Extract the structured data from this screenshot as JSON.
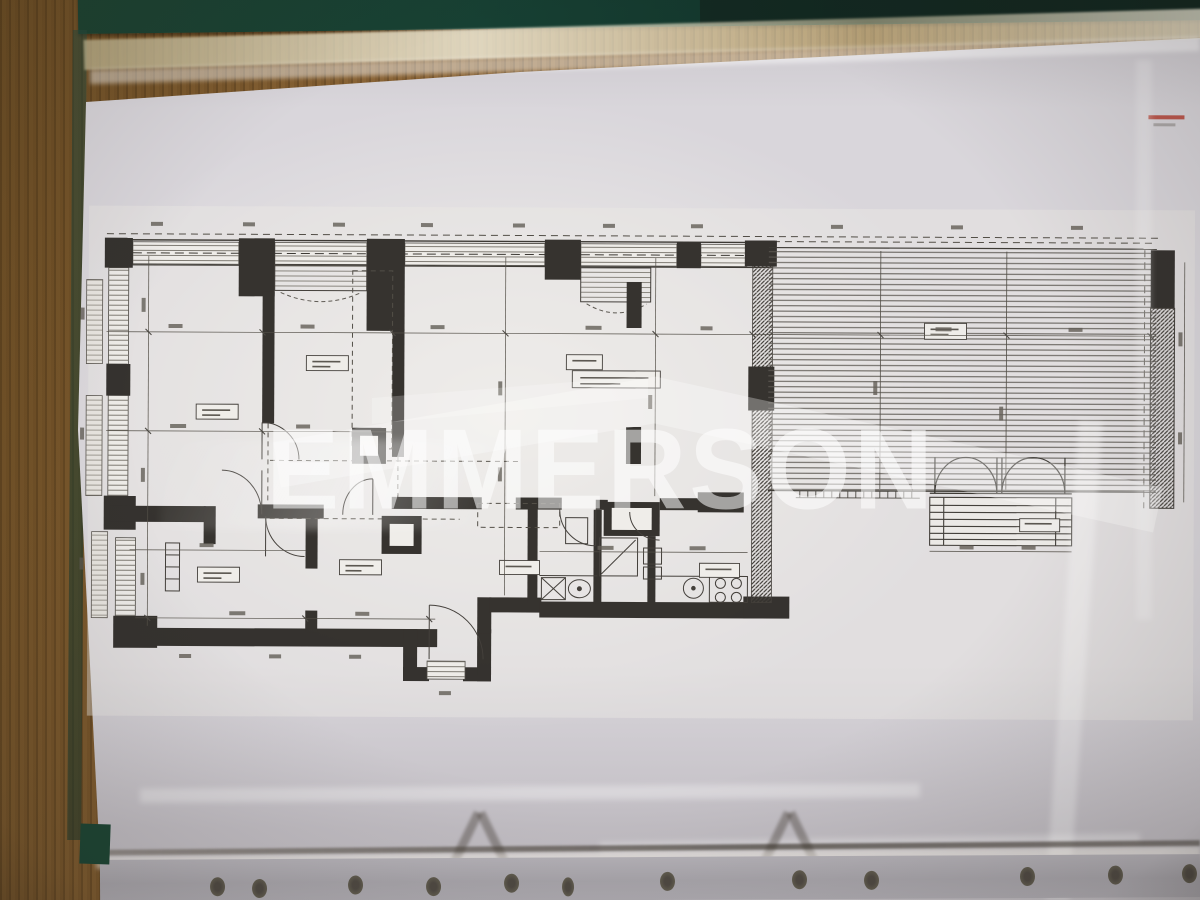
{
  "photo": {
    "watermark": {
      "text": "EMMERSON"
    },
    "colors": {
      "desk_wood": "#8a6436",
      "binder_green": "#16382b",
      "sleeve_highlight": "#ded5b4",
      "paper": "#d9d6db",
      "plan_ink": "#2d2a26",
      "terrace_deck_line": "#56524b",
      "watermark": "#ffffff",
      "red_annotation": "#b5382c",
      "binder_hole": "#4a443c"
    }
  }
}
